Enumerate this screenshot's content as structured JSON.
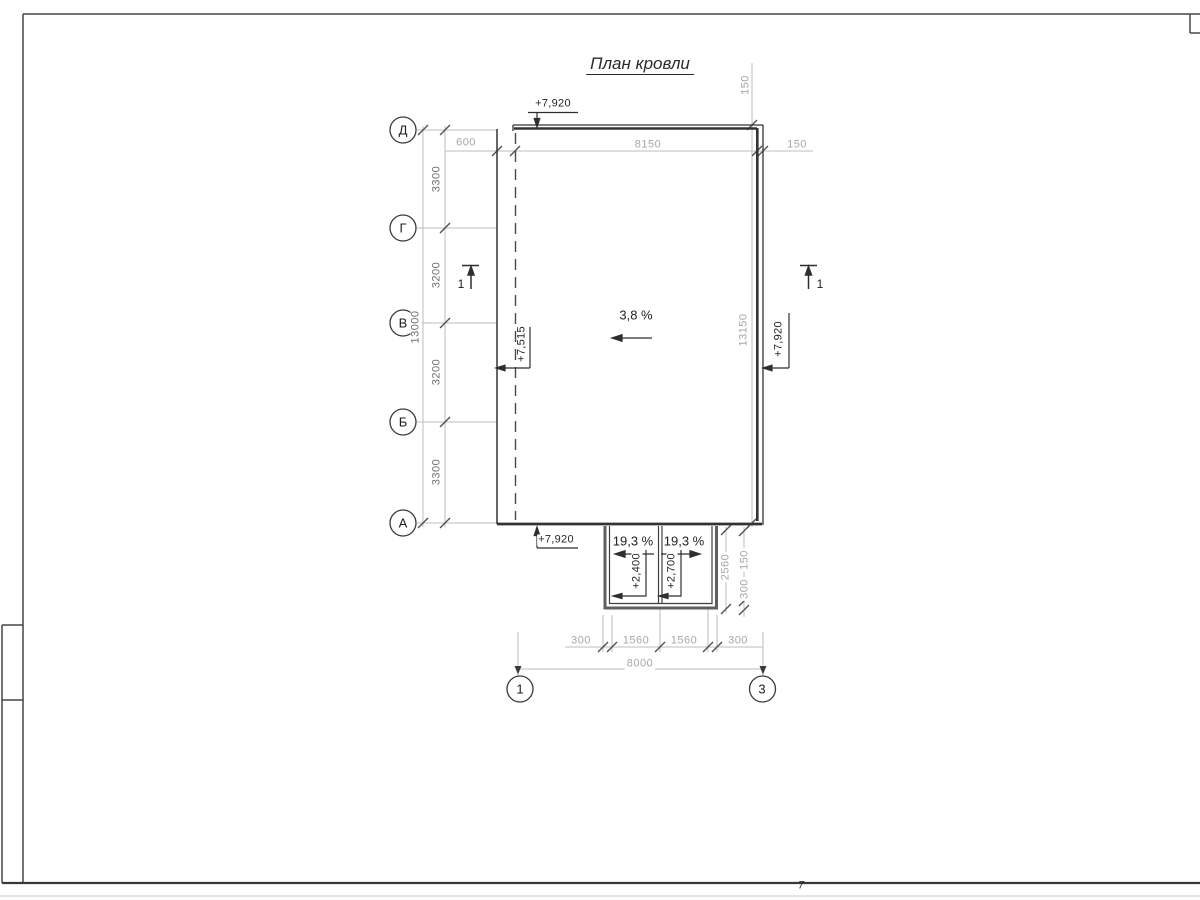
{
  "colors": {
    "drawing_line": "#333333",
    "thick_line": "#3a3a3a",
    "canopy_line": "#5f5f5f",
    "dim_line": "#bdbdbd",
    "dim_text_light": "#a6a6a6",
    "dim_text_mid": "#6f6f6f",
    "dark_text": "#262626"
  },
  "title": "План кровли",
  "axes": {
    "row": [
      "Д",
      "Г",
      "В",
      "Б",
      "А"
    ],
    "col_left": "1",
    "col_right": "3"
  },
  "left_dims": {
    "segments": [
      "3300",
      "3200",
      "3200",
      "3300"
    ],
    "total": "13000"
  },
  "top_dims": {
    "overhang": "600",
    "span": "8150",
    "edge": "150",
    "parapet": "150"
  },
  "right_dims": {
    "total": "13150"
  },
  "bottom_dims": {
    "segments": [
      "300",
      "1560",
      "1560",
      "300"
    ],
    "total": "8000"
  },
  "canopy_dims": {
    "depth": "2560",
    "edge": "150",
    "wall": "300"
  },
  "elevations": {
    "top": "+7,920",
    "left": "+7,515",
    "right": "+7,920",
    "bottom": "+7,920",
    "canopy_left": "+2,400",
    "canopy_right": "+2,700"
  },
  "slopes": {
    "main": "3,8 %",
    "canopy_left": "19,3 %",
    "canopy_right": "19,3 %"
  },
  "sections": {
    "left": "1",
    "right": "1"
  },
  "page_mark": "7"
}
